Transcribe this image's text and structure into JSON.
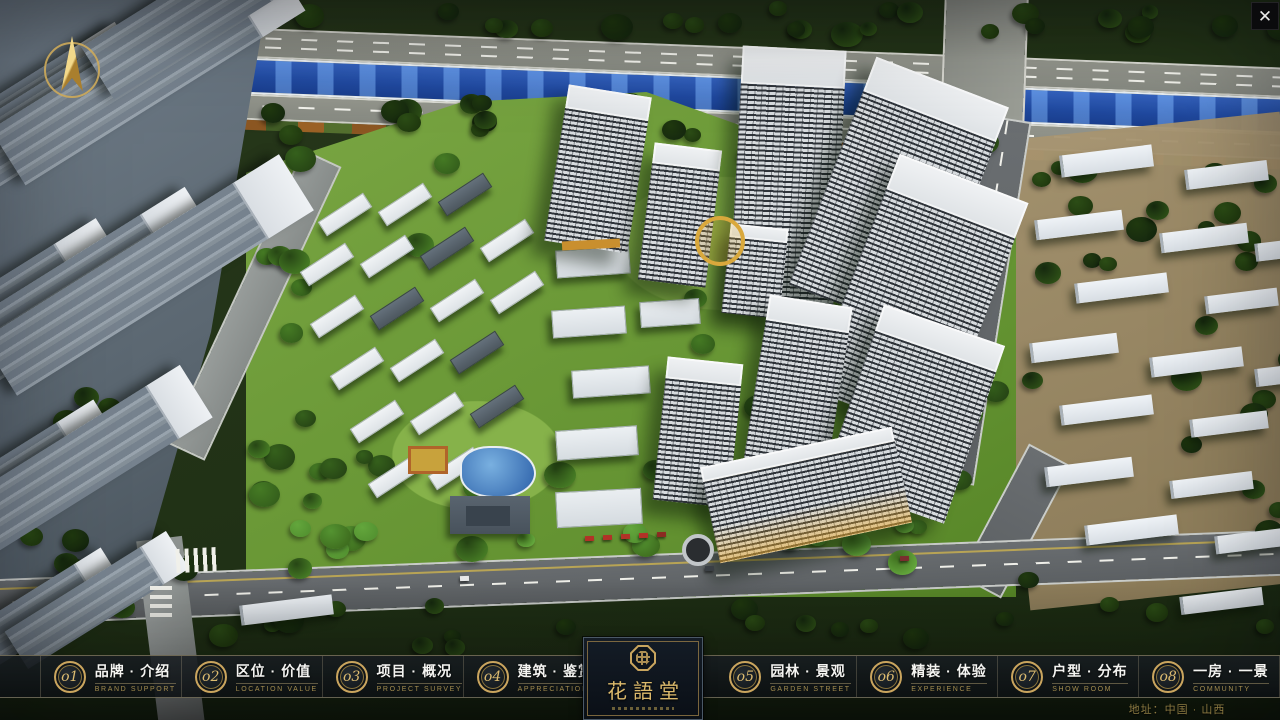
{
  "nav": {
    "items": [
      {
        "num": "o1",
        "label": "品牌 · 介绍",
        "sub": "BRAND SUPPORT"
      },
      {
        "num": "o2",
        "label": "区位 · 价值",
        "sub": "LOCATION VALUE"
      },
      {
        "num": "o3",
        "label": "项目 · 概况",
        "sub": "PROJECT SURVEY"
      },
      {
        "num": "o4",
        "label": "建筑 · 鉴赏",
        "sub": "APPRECIATION"
      },
      {
        "num": "o5",
        "label": "园林 · 景观",
        "sub": "GARDEN STREET"
      },
      {
        "num": "o6",
        "label": "精装 · 体验",
        "sub": "EXPERIENCE"
      },
      {
        "num": "o7",
        "label": "户型 · 分布",
        "sub": "SHOW ROOM"
      },
      {
        "num": "o8",
        "label": "一房 · 一景",
        "sub": "COMMUNITY"
      }
    ],
    "logo": {
      "title": "花語堂"
    }
  },
  "footer": {
    "address": "地址：中国 · 山西"
  },
  "icons": {
    "close": "✕",
    "compass": "north-compass",
    "seal": "seal-emblem"
  },
  "colors": {
    "gold": "#c9a55e",
    "bar_bg": "#12171b",
    "river": "#2f62c4",
    "accent_text": "#a38c4f",
    "label_text": "#f4f4f1"
  }
}
